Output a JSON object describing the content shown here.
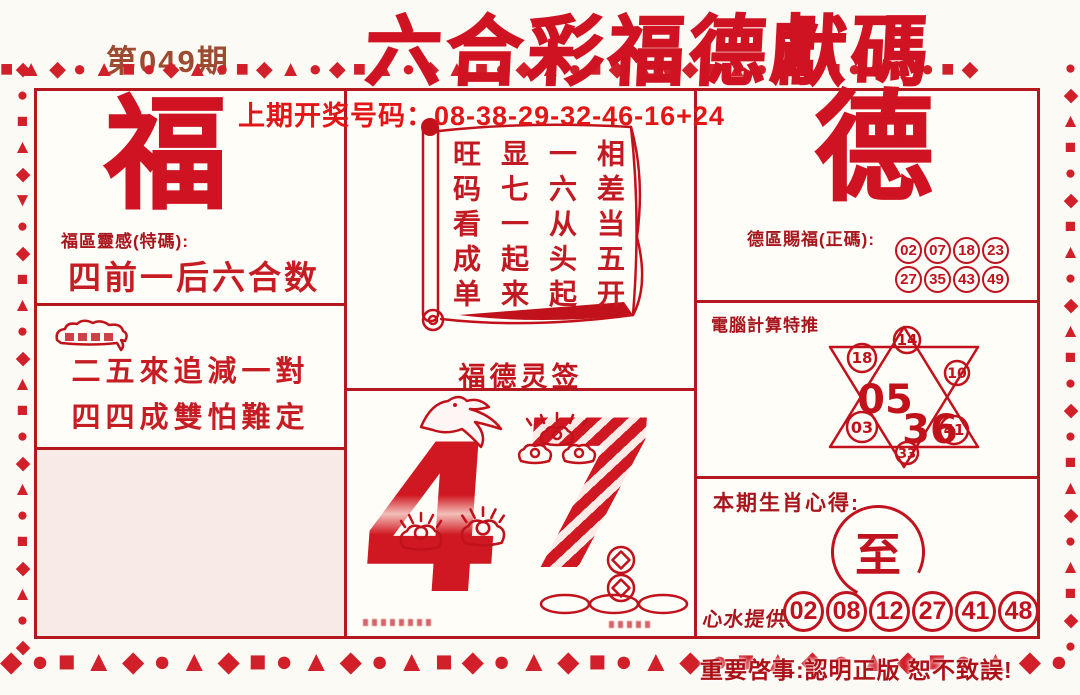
{
  "page": {
    "issue": "第049期",
    "title": "六合彩福德獻碼",
    "prev_draw": "上期开奖号码：08-38-29-32-46-16+24",
    "footer": "重要啓事:認明正版  恕不致誤!"
  },
  "left_panel": {
    "big_char": "福",
    "label": "福區靈感(特碼):",
    "slogan": "四前一后六合数",
    "couplet_line1": "二五來追減一對",
    "couplet_line2": "四四成雙怕難定"
  },
  "scroll_panel": {
    "columns": [
      "相差当五开",
      "一六从头起",
      "显七一起来",
      "旺码看成单"
    ],
    "caption": "福德灵签"
  },
  "art_panel": {
    "digit_left": "4",
    "digit_right": "7"
  },
  "right_panel": {
    "big_char": "德",
    "label": "德區賜福(正碼):",
    "grid_numbers": [
      "02",
      "07",
      "18",
      "23",
      "27",
      "35",
      "43",
      "49"
    ],
    "star_label": "電腦計算特推",
    "star_points": {
      "top": "14",
      "upper_left": "18",
      "upper_right": "10",
      "lower_left": "03",
      "lower_right": "41",
      "bottom": "33"
    },
    "star_center": {
      "first": "05",
      "second": "36"
    },
    "zodiac_label": "本期生肖心得:",
    "zodiac_char": "至",
    "tips_label": "心水提供:",
    "tips_numbers": [
      "02",
      "08",
      "12",
      "27",
      "41",
      "48"
    ]
  },
  "border": {
    "top": "■▲◆●▲■●◆▲●■◆▲●◆■▲●◆▲■●◆▲●■◆▲●◆■▲●◆▲■●◆▲●■◆",
    "bottom": "◆●■▲◆●▲◆■●▲◆●▲■◆●▲◆■●▲◆●■▲◆●▲◆■●▲◆●▲■◆●▲◆",
    "left": "◆●■▲◆▼●◆■▲●◆▲■●◆▲●■◆▲●◆■▲●◆▲●■◆●",
    "right": "●◆▲■●◆■▲●◆▲■●◆●■▲◆●▲■◆●▲◆■●▲◆●▲■"
  },
  "colors": {
    "main_red": "#cf1322",
    "dark_red": "#a8151d",
    "issue_brown": "#9c4a30",
    "line_red": "#b5171e"
  }
}
